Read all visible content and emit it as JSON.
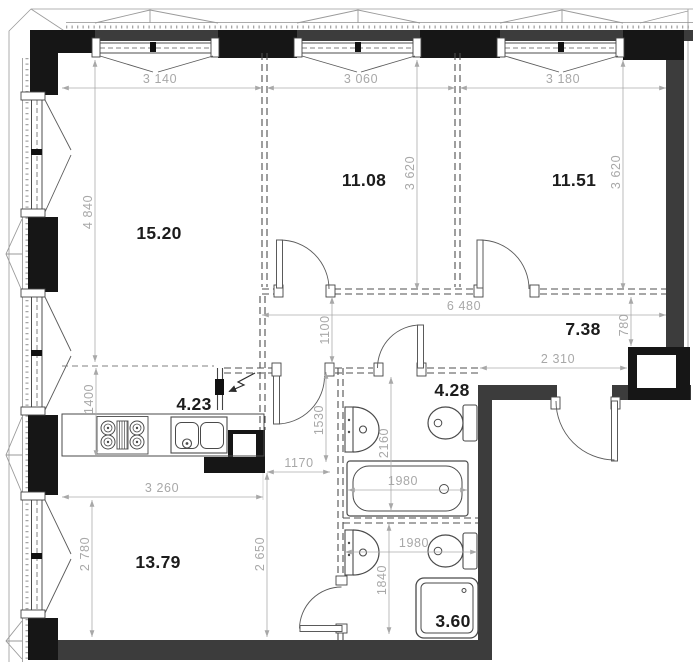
{
  "plan_title": "Apartment floor plan",
  "rooms": {
    "living": "15.20",
    "bedroom1": "11.08",
    "bedroom2": "11.51",
    "hallway": "7.38",
    "kitchen": "4.23",
    "bathroom1": "4.28",
    "room3": "13.79",
    "bathroom2": "3.60"
  },
  "dims": {
    "w1": "3 140",
    "w2": "3 060",
    "w3": "3 180",
    "living_h": "4 840",
    "b1_h": "3 620",
    "b2_h": "3 620",
    "hall_w": "6 480",
    "hall_h": "1100",
    "entry_d": "780",
    "entry_w": "2 310",
    "kitchen_d": "1400",
    "corr_l": "1530",
    "bath1_d": "2160",
    "corr_w": "1170",
    "kitchen_w": "3 260",
    "room3_hl": "2 780",
    "room3_hr": "2 650",
    "tub_w": "1980",
    "bath2_w": "1980",
    "bath2_d": "1840"
  },
  "colors": {
    "wall_gray": "#3c3c3c",
    "wall_black": "#161616",
    "dim_line": "#ababab",
    "dim_text": "#a8a8a8",
    "draw_line": "#555555",
    "room_text": "#1c1c1c"
  }
}
